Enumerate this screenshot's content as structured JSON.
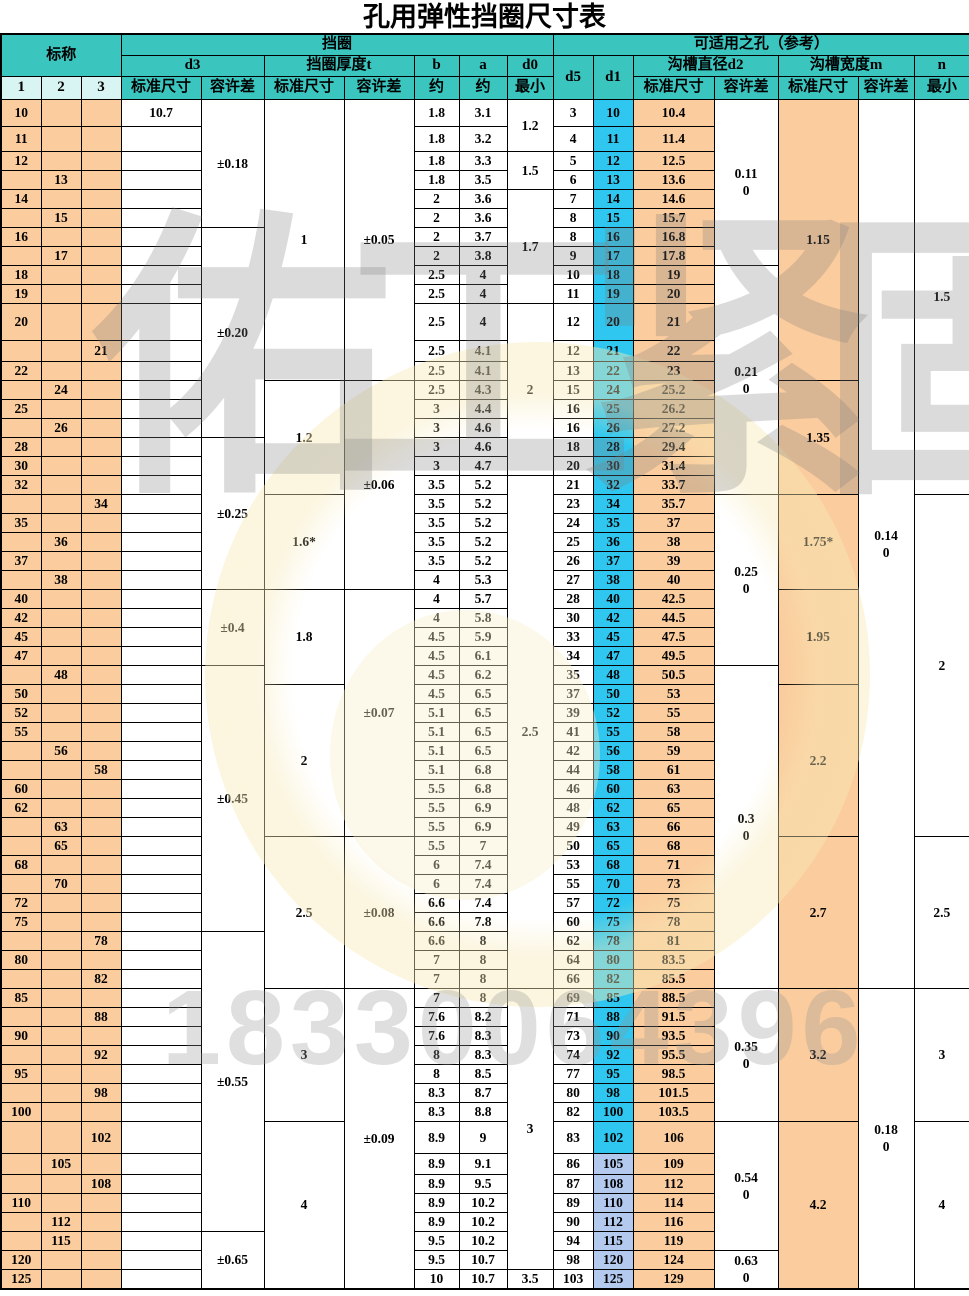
{
  "title": "孔用弹性挡圈尺寸表",
  "header": {
    "nominal": "标称",
    "nom_cols": [
      "1",
      "2",
      "3"
    ],
    "ring_group": "挡圈",
    "hole_group": "可适用之孔（参考）",
    "d3": "d3",
    "t_group": "挡圈厚度t",
    "b": "b",
    "a": "a",
    "d0": "d0",
    "d5": "d5",
    "d1": "d1",
    "d2_group": "沟槽直径d2",
    "m_group": "沟槽宽度m",
    "n": "n",
    "std": "标准尺寸",
    "tol": "容许差",
    "approx": "约",
    "min": "最小"
  },
  "colors": {
    "header_teal": "#3bc5bf",
    "header_light_cyan": "#d9f5f3",
    "peach": "#fbcc9d",
    "d1_cyan": "#2fc7ef",
    "d1_periwinkle": "#b3c9ee",
    "border": "#000000",
    "watermark_gray": "#7d7d7d",
    "watermark_tan": "#caa76e"
  },
  "watermark": {
    "brand_left": "佑工紧固",
    "brand_tail": "件",
    "phone": "18330064396"
  },
  "table": {
    "d1_light_rows": [
      "105",
      "108",
      "110",
      "112",
      "115",
      "120",
      "125"
    ],
    "rows": [
      [
        1,
        "10",
        "10.7",
        "1.8",
        "3.1",
        "3",
        "10",
        "10.4",
        27
      ],
      [
        1,
        "11",
        "",
        "1.8",
        "3.2",
        "4",
        "11",
        "11.4",
        25
      ],
      [
        1,
        "12",
        "",
        "1.8",
        "3.3",
        "5",
        "12",
        "12.5",
        0
      ],
      [
        2,
        "13",
        "",
        "1.8",
        "3.5",
        "6",
        "13",
        "13.6",
        0
      ],
      [
        1,
        "14",
        "",
        "2",
        "3.6",
        "7",
        "14",
        "14.6",
        0
      ],
      [
        2,
        "15",
        "",
        "2",
        "3.6",
        "8",
        "15",
        "15.7",
        0
      ],
      [
        1,
        "16",
        "",
        "2",
        "3.7",
        "8",
        "16",
        "16.8",
        0
      ],
      [
        2,
        "17",
        "",
        "2",
        "3.8",
        "9",
        "17",
        "17.8",
        0
      ],
      [
        1,
        "18",
        "",
        "2.5",
        "4",
        "10",
        "18",
        "19",
        0
      ],
      [
        1,
        "19",
        "",
        "2.5",
        "4",
        "11",
        "19",
        "20",
        0
      ],
      [
        1,
        "20",
        "",
        "2.5",
        "4",
        "12",
        "20",
        "21",
        37
      ],
      [
        3,
        "21",
        "",
        "2.5",
        "4.1",
        "12",
        "21",
        "22",
        21
      ],
      [
        1,
        "22",
        "",
        "2.5",
        "4.1",
        "13",
        "22",
        "23",
        0
      ],
      [
        2,
        "24",
        "",
        "2.5",
        "4.3",
        "15",
        "24",
        "25.2",
        0
      ],
      [
        1,
        "25",
        "",
        "3",
        "4.4",
        "16",
        "25",
        "26.2",
        0
      ],
      [
        2,
        "26",
        "",
        "3",
        "4.6",
        "16",
        "26",
        "27.2",
        0
      ],
      [
        1,
        "28",
        "",
        "3",
        "4.6",
        "18",
        "28",
        "29.4",
        0
      ],
      [
        1,
        "30",
        "",
        "3",
        "4.7",
        "20",
        "30",
        "31.4",
        0
      ],
      [
        1,
        "32",
        "",
        "3.5",
        "5.2",
        "21",
        "32",
        "33.7",
        0
      ],
      [
        3,
        "34",
        "",
        "3.5",
        "5.2",
        "23",
        "34",
        "35.7",
        0
      ],
      [
        1,
        "35",
        "",
        "3.5",
        "5.2",
        "24",
        "35",
        "37",
        0
      ],
      [
        2,
        "36",
        "",
        "3.5",
        "5.2",
        "25",
        "36",
        "38",
        0
      ],
      [
        1,
        "37",
        "",
        "3.5",
        "5.2",
        "26",
        "37",
        "39",
        0
      ],
      [
        2,
        "38",
        "",
        "4",
        "5.3",
        "27",
        "38",
        "40",
        0
      ],
      [
        1,
        "40",
        "",
        "4",
        "5.7",
        "28",
        "40",
        "42.5",
        0
      ],
      [
        1,
        "42",
        "",
        "4",
        "5.8",
        "30",
        "42",
        "44.5",
        0
      ],
      [
        1,
        "45",
        "",
        "4.5",
        "5.9",
        "33",
        "45",
        "47.5",
        0
      ],
      [
        1,
        "47",
        "",
        "4.5",
        "6.1",
        "34",
        "47",
        "49.5",
        0
      ],
      [
        2,
        "48",
        "",
        "4.5",
        "6.2",
        "35",
        "48",
        "50.5",
        0
      ],
      [
        1,
        "50",
        "",
        "4.5",
        "6.5",
        "37",
        "50",
        "53",
        0
      ],
      [
        1,
        "52",
        "",
        "5.1",
        "6.5",
        "39",
        "52",
        "55",
        0
      ],
      [
        1,
        "55",
        "",
        "5.1",
        "6.5",
        "41",
        "55",
        "58",
        0
      ],
      [
        2,
        "56",
        "",
        "5.1",
        "6.5",
        "42",
        "56",
        "59",
        0
      ],
      [
        3,
        "58",
        "",
        "5.1",
        "6.8",
        "44",
        "58",
        "61",
        0
      ],
      [
        1,
        "60",
        "",
        "5.5",
        "6.8",
        "46",
        "60",
        "63",
        0
      ],
      [
        1,
        "62",
        "",
        "5.5",
        "6.9",
        "48",
        "62",
        "65",
        0
      ],
      [
        2,
        "63",
        "",
        "5.5",
        "6.9",
        "49",
        "63",
        "66",
        0
      ],
      [
        2,
        "65",
        "",
        "5.5",
        "7",
        "50",
        "65",
        "68",
        0
      ],
      [
        1,
        "68",
        "",
        "6",
        "7.4",
        "53",
        "68",
        "71",
        0
      ],
      [
        2,
        "70",
        "",
        "6",
        "7.4",
        "55",
        "70",
        "73",
        0
      ],
      [
        1,
        "72",
        "",
        "6.6",
        "7.4",
        "57",
        "72",
        "75",
        0
      ],
      [
        1,
        "75",
        "",
        "6.6",
        "7.8",
        "60",
        "75",
        "78",
        0
      ],
      [
        3,
        "78",
        "",
        "6.6",
        "8",
        "62",
        "78",
        "81",
        0
      ],
      [
        1,
        "80",
        "",
        "7",
        "8",
        "64",
        "80",
        "83.5",
        0
      ],
      [
        3,
        "82",
        "",
        "7",
        "8",
        "66",
        "82",
        "85.5",
        0
      ],
      [
        1,
        "85",
        "",
        "7",
        "8",
        "69",
        "85",
        "88.5",
        0
      ],
      [
        3,
        "88",
        "",
        "7.6",
        "8.2",
        "71",
        "88",
        "91.5",
        0
      ],
      [
        1,
        "90",
        "",
        "7.6",
        "8.3",
        "73",
        "90",
        "93.5",
        0
      ],
      [
        3,
        "92",
        "",
        "8",
        "8.3",
        "74",
        "92",
        "95.5",
        0
      ],
      [
        1,
        "95",
        "",
        "8",
        "8.5",
        "77",
        "95",
        "98.5",
        0
      ],
      [
        3,
        "98",
        "",
        "8.3",
        "8.7",
        "80",
        "98",
        "101.5",
        0
      ],
      [
        1,
        "100",
        "",
        "8.3",
        "8.8",
        "82",
        "100",
        "103.5",
        0
      ],
      [
        3,
        "102",
        "",
        "8.9",
        "9",
        "83",
        "102",
        "106",
        32
      ],
      [
        2,
        "105",
        "",
        "8.9",
        "9.1",
        "86",
        "105",
        "109",
        21
      ],
      [
        3,
        "108",
        "",
        "8.9",
        "9.5",
        "87",
        "108",
        "112",
        0
      ],
      [
        1,
        "110",
        "",
        "8.9",
        "10.2",
        "89",
        "110",
        "114",
        0
      ],
      [
        2,
        "112",
        "",
        "8.9",
        "10.2",
        "90",
        "112",
        "116",
        0
      ],
      [
        2,
        "115",
        "",
        "9.5",
        "10.2",
        "94",
        "115",
        "119",
        0
      ],
      [
        1,
        "120",
        "",
        "9.5",
        "10.7",
        "98",
        "120",
        "124",
        0
      ],
      [
        1,
        "125",
        "",
        "10",
        "10.7",
        "103",
        "125",
        "129",
        0
      ]
    ],
    "merges": {
      "d3tol": [
        [
          "10",
          "15",
          "±0.18"
        ],
        [
          "16",
          "26",
          "±0.20"
        ],
        [
          "28",
          "38",
          "±0.25"
        ],
        [
          "40",
          "47",
          "±0.4"
        ],
        [
          "48",
          "75",
          "±0.45"
        ],
        [
          "78",
          "112",
          "±0.55"
        ],
        [
          "115",
          "125",
          "±0.65"
        ]
      ],
      "tstd": [
        [
          "10",
          "22",
          "1"
        ],
        [
          "24",
          "32",
          "1.2"
        ],
        [
          "34",
          "38",
          "1.6*"
        ],
        [
          "40",
          "48",
          "1.8"
        ],
        [
          "50",
          "63",
          "2"
        ],
        [
          "65",
          "82",
          "2.5"
        ],
        [
          "85",
          "100",
          "3"
        ],
        [
          "102",
          "125",
          "4"
        ]
      ],
      "ttol": [
        [
          "10",
          "22",
          "±0.05"
        ],
        [
          "24",
          "38",
          "±0.06"
        ],
        [
          "40",
          "63",
          "±0.07"
        ],
        [
          "65",
          "82",
          "±0.08"
        ],
        [
          "85",
          "125",
          "±0.09"
        ]
      ],
      "d0": [
        [
          "10",
          "11",
          "1.2"
        ],
        [
          "12",
          "13",
          "1.5"
        ],
        [
          "14",
          "19",
          "1.7"
        ],
        [
          "20",
          "30",
          "2"
        ],
        [
          "32",
          "82",
          "2.5"
        ],
        [
          "85",
          "120",
          "3"
        ],
        [
          "125",
          "125",
          "3.5"
        ]
      ],
      "d2tol": [
        [
          "10",
          "17",
          "0.11\n0"
        ],
        [
          "18",
          "32",
          "0.21\n0"
        ],
        [
          "34",
          "47",
          "0.25\n0"
        ],
        [
          "48",
          "82",
          "0.3\n0"
        ],
        [
          "85",
          "100",
          "0.35\n0"
        ],
        [
          "102",
          "115",
          "0.54\n0"
        ],
        [
          "120",
          "125",
          "0.63\n0"
        ]
      ],
      "mstd": [
        [
          "10",
          "22",
          "1.15"
        ],
        [
          "24",
          "32",
          "1.35"
        ],
        [
          "34",
          "38",
          "1.75*"
        ],
        [
          "40",
          "48",
          "1.95"
        ],
        [
          "50",
          "63",
          "2.2"
        ],
        [
          "65",
          "82",
          "2.7"
        ],
        [
          "85",
          "100",
          "3.2"
        ],
        [
          "102",
          "125",
          "4.2"
        ]
      ],
      "mtol": [
        [
          "10",
          "82",
          "0.14\n0"
        ],
        [
          "85",
          "125",
          "0.18\n0"
        ]
      ],
      "nmin": [
        [
          "10",
          "32",
          "1.5"
        ],
        [
          "34",
          "63",
          "2"
        ],
        [
          "65",
          "82",
          "2.5"
        ],
        [
          "85",
          "100",
          "3"
        ],
        [
          "102",
          "125",
          "4"
        ]
      ]
    }
  }
}
